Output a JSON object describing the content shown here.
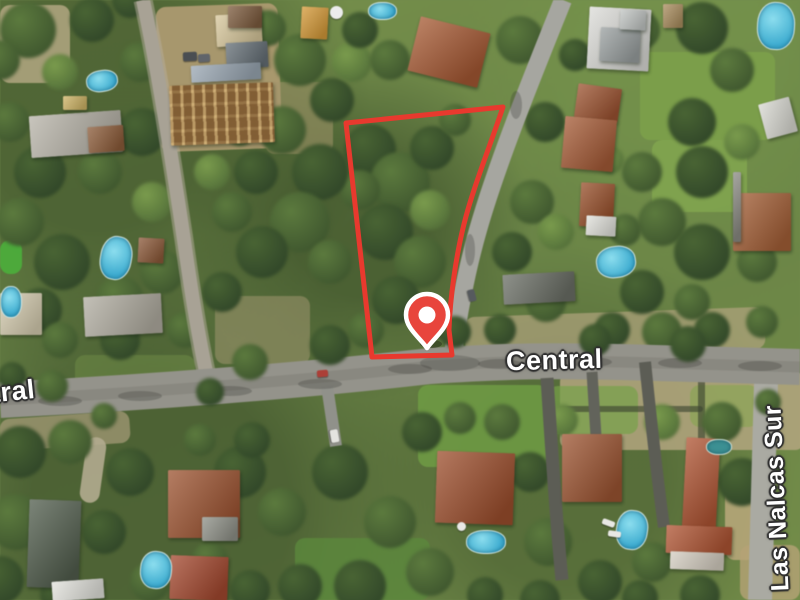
{
  "map": {
    "street_labels": {
      "central": "Central",
      "las_nalcas_sur": "Las Nalcas Sur"
    },
    "overlay": {
      "parcel_boundary_color": "#e8392e",
      "pin_color": "#e8453c",
      "pin_ring_color": "#ffffff"
    },
    "imagery_colors": {
      "vegetation": "#6f8a4e",
      "road": "#94938b",
      "roof_terracotta": "#9a5535",
      "pool_water": "#45b6d6"
    }
  }
}
